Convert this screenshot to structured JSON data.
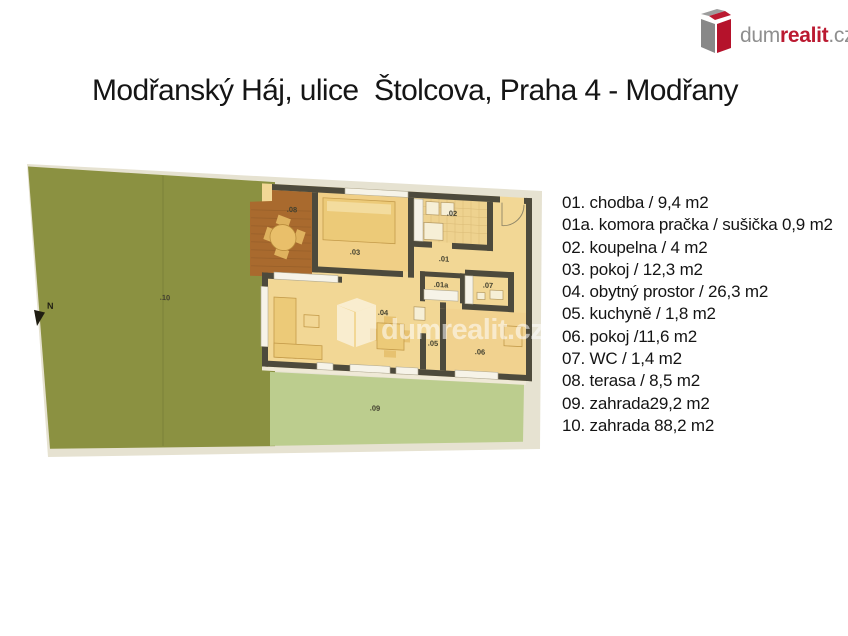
{
  "header": {
    "title": "Modřanský Háj, ulice  Štolcova, Praha 4 - Modřany"
  },
  "logo": {
    "dum": "dum",
    "realit": "realit",
    "cz": ".cz"
  },
  "legend": {
    "items": [
      "01. chodba / 9,4 m2",
      "01a. komora pračka / sušička 0,9 m2",
      "02. koupelna / 4 m2",
      "03. pokoj / 12,3 m2",
      "04. obytný prostor / 26,3 m2",
      "05. kuchyně / 1,8 m2",
      "06. pokoj /11,6 m2",
      "07. WC / 1,4 m2",
      "08. terasa / 8,5 m2",
      "09. zahrada29,2 m2",
      "10. zahrada 88,2 m2"
    ]
  },
  "plan": {
    "north": "N",
    "watermark": "dumrealit.cz",
    "labels": {
      "r01": ".01",
      "r01a": ".01a",
      "r02": ".02",
      "r03": ".03",
      "r04": ".04",
      "r05": ".05",
      "r06": ".06",
      "r07": ".07",
      "r08": ".08",
      "r09": ".09",
      "r10": ".10"
    },
    "colors": {
      "garden_dark": "#8b9141",
      "garden_light": "#bccd8e",
      "terrace": "#a96a2e",
      "floor": "#f2d795",
      "wall": "#4d4a3c",
      "paper": "#e6e2d1",
      "accent_red": "#bb1a31",
      "logo_gray": "#8f8f8f"
    }
  }
}
